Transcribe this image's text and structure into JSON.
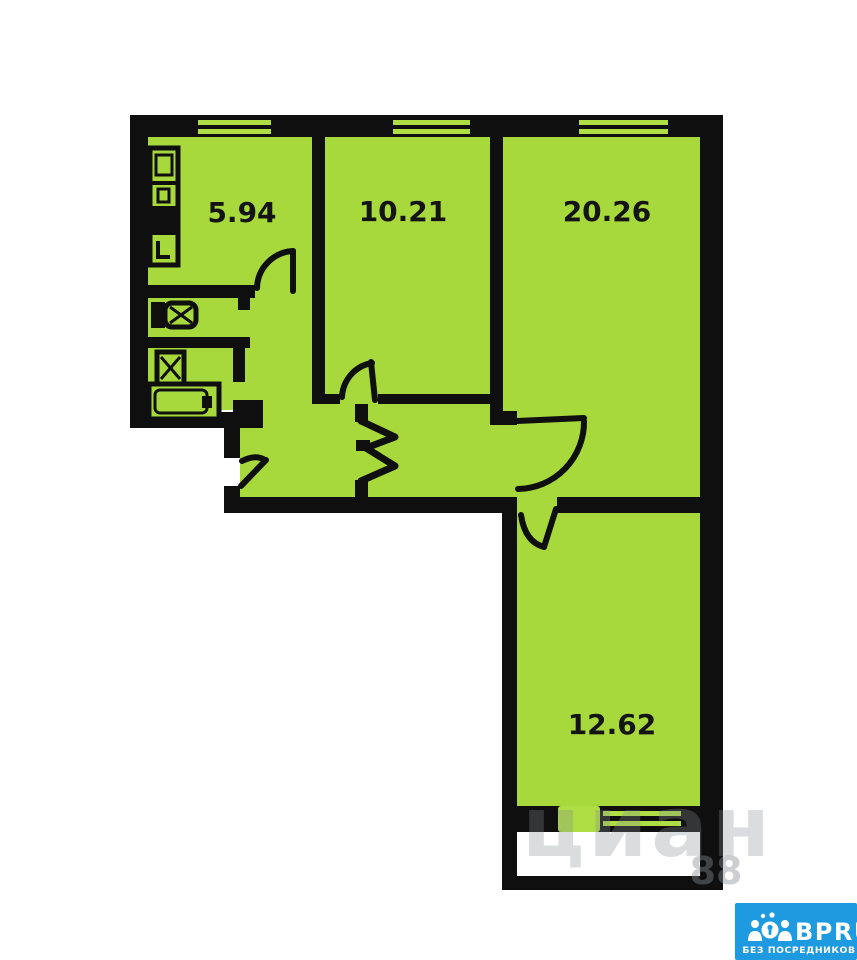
{
  "floorplan": {
    "type": "apartment-floor-plan",
    "wall_color": "#0f0f0f",
    "room_fill": "#a8d93c",
    "background": "#ffffff",
    "rooms": [
      {
        "id": "kitchen",
        "area": "5.94"
      },
      {
        "id": "room-1",
        "area": "10.21"
      },
      {
        "id": "living-room",
        "area": "20.26"
      },
      {
        "id": "room-2",
        "area": "12.62"
      }
    ],
    "fixtures": [
      "kitchen-appliances",
      "toilet",
      "sink",
      "bathtub",
      "built-in-closet",
      "balcony"
    ],
    "windows_count": 4
  },
  "watermark": {
    "text": "циан",
    "number": "88"
  },
  "logo": {
    "brand": "BPRU",
    "tagline": "БЕЗ ПОСРЕДНИКОВ",
    "bg_color": "#1e9ae0",
    "text_color": "#ffffff"
  }
}
